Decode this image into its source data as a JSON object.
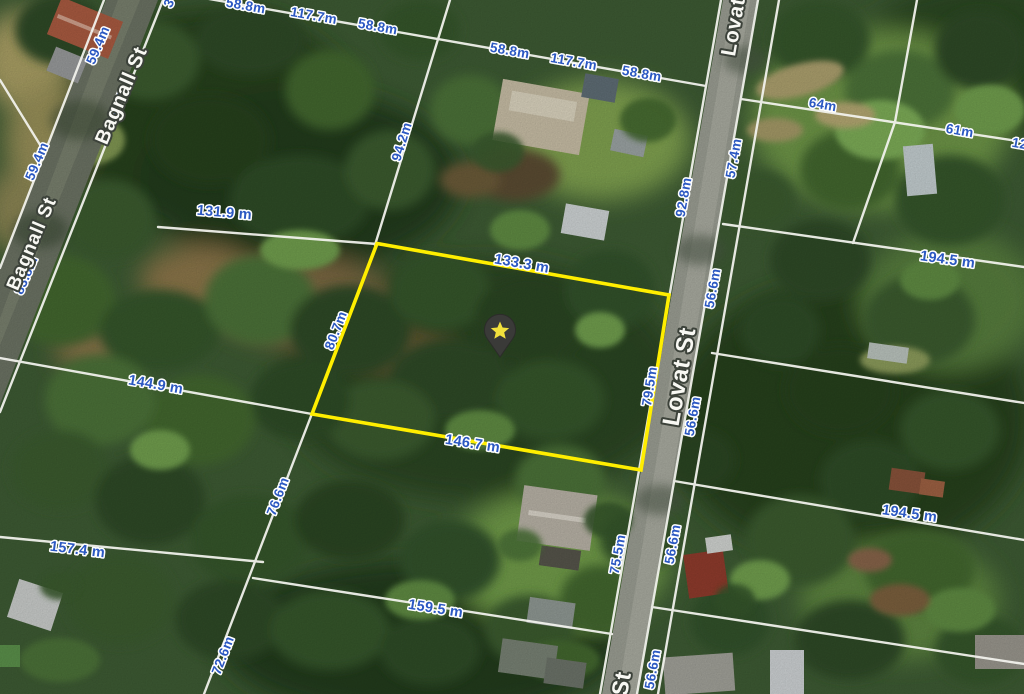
{
  "map": {
    "type": "aerial-cadastral-map",
    "streets": {
      "bagnall_upper": "Bagnall St",
      "bagnall_lower": "Bagnall St",
      "lovat_top": "Lovat",
      "lovat_mid": "Lovat St",
      "lovat_bottom": "St"
    },
    "selected_parcel": {
      "outline_color": "#ffee00",
      "marker": "star-pin",
      "dimensions": {
        "top": "133.3 m",
        "bottom": "146.7 m",
        "right": "79.5m",
        "left": "80.7m"
      }
    },
    "measurements": {
      "top_boundary": [
        "58.8m",
        "117.7m",
        "58.8m",
        "58.8m",
        "117.7m",
        "58.8m"
      ],
      "top_partial": "3",
      "bagnall_frontage": [
        "59.4m",
        "94.5m",
        "59.4m",
        "83.8m"
      ],
      "west_parcels": [
        "131.9 m",
        "144.9 m",
        "157.4 m",
        "159.5 m",
        "94.2m",
        "76.6m",
        "72.6m",
        "75.5m",
        "92.8m"
      ],
      "lovat_east_frontage": [
        "57.4m",
        "56.6m",
        "56.6m",
        "56.6m",
        "56.6m"
      ],
      "east_parcels": [
        "64m",
        "61m",
        "12",
        "194.5 m",
        "194.5 m"
      ]
    },
    "colors": {
      "measurement_text": "#2b58c2",
      "street_text": "#f8f8f3",
      "boundary_line": "#f4f4ef",
      "highlight": "#ffee00",
      "marker_body": "#3a3a38",
      "marker_star": "#f2e03c"
    }
  }
}
